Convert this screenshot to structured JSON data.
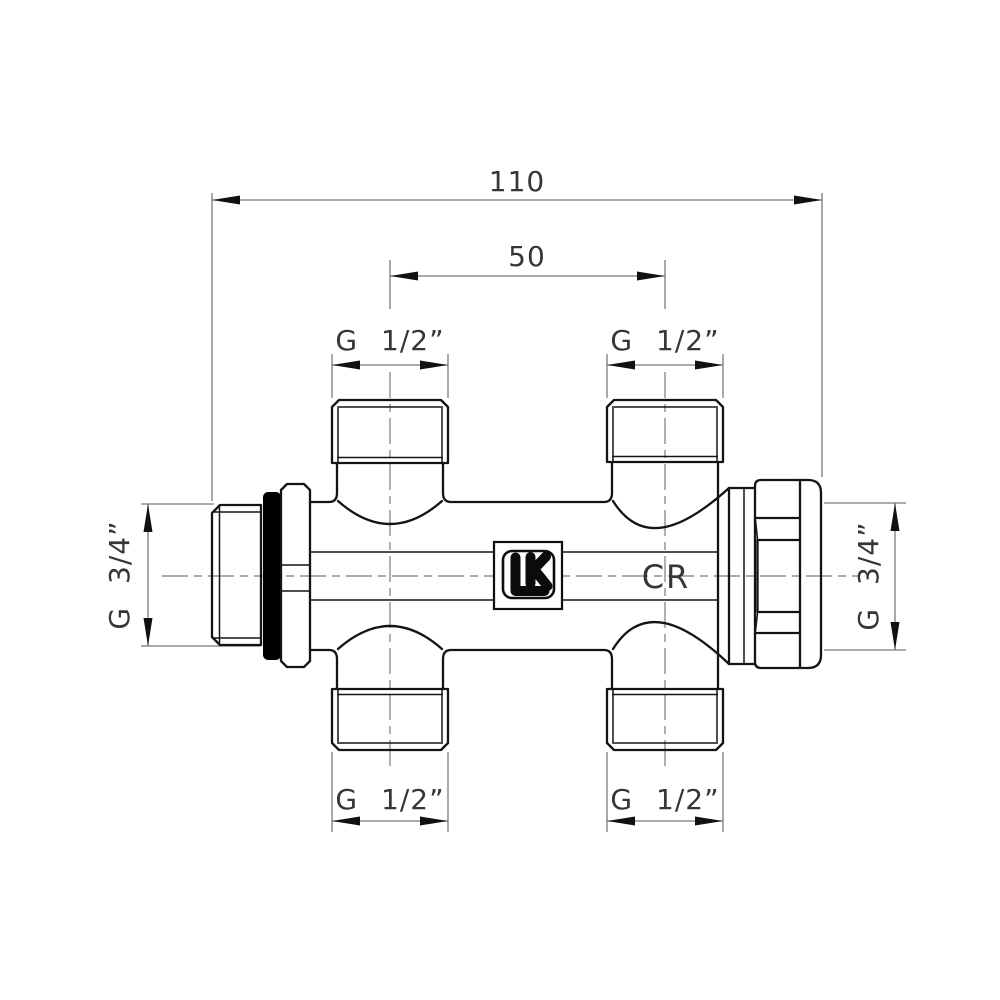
{
  "drawing": {
    "dimensions": {
      "overall_length": "110",
      "port_spacing": "50",
      "port_thread_top_left": "G 1/2”",
      "port_thread_top_right": "G 1/2”",
      "port_thread_bottom_left": "G 1/2”",
      "port_thread_bottom_right": "G 1/2”",
      "end_thread_left": "G 3/4”",
      "end_thread_right": "G 3/4”"
    },
    "markings": {
      "logo": "LK",
      "body": "CR"
    },
    "colors": {
      "background": "#ffffff",
      "outline": "#141414",
      "dimension_line": "#7b7b7b",
      "arrow": "#111111",
      "text": "#363636",
      "seal_ring": "#000000"
    }
  }
}
